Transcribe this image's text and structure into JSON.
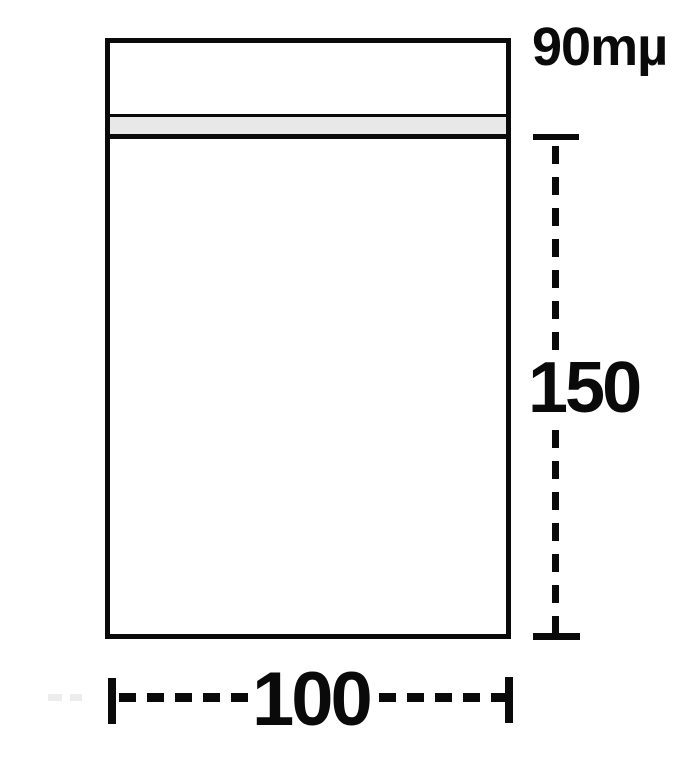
{
  "diagram": {
    "thickness_label": "90mµ",
    "height_label": "150",
    "width_label": "100",
    "colors": {
      "line": "#0a0a0a",
      "seal_fill": "#e8e8e8",
      "background": "#ffffff",
      "faint_mark": "#ececec"
    }
  }
}
